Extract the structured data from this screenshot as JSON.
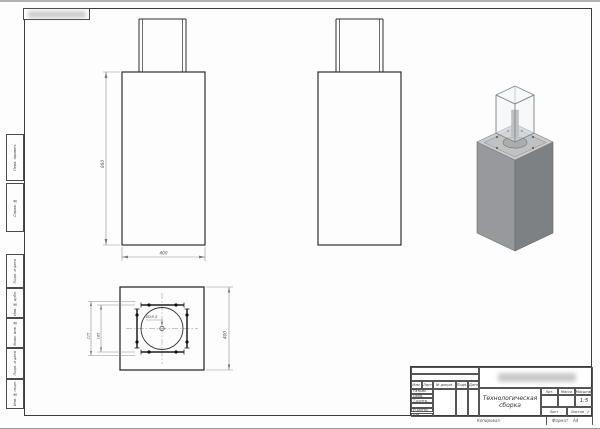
{
  "margin_labels": [
    {
      "label": "Перв. примен."
    },
    {
      "label": "Справ. №"
    },
    {
      "label": "Подп. и дата"
    },
    {
      "label": "Инв. № дубл."
    },
    {
      "label": "Взам. инв. №"
    },
    {
      "label": "Подп. и дата"
    },
    {
      "label": "Инв. № подл."
    }
  ],
  "views": {
    "front": {
      "height_dim": "860",
      "width_dim": "400"
    },
    "plan": {
      "outer_dim": "400",
      "rail_outer_dim": "215",
      "rail_inner_dim": "185",
      "hole_dim": "Ø28,5"
    }
  },
  "title_block": {
    "title": "Технологическая\nсборка",
    "col_izm": "Изм.",
    "col_list": "Лист",
    "col_doc": "№ докум.",
    "col_sign": "Подп.",
    "col_date": "Дата",
    "rows": [
      "Разраб.",
      "Пров.",
      "Т.контр.",
      "",
      "Н.контр.",
      "Утв."
    ],
    "lit": "Лит.",
    "mass": "Масса",
    "scale_label": "Масштаб",
    "scale_value": "1:5",
    "sheet_label": "Лист",
    "sheets_label": "Листов",
    "sheets_value": "1"
  },
  "footer": {
    "copied": "Копировал",
    "format_label": "Формат",
    "format_value": "A4"
  },
  "colors": {
    "object_line": "#2f2f2f",
    "dim_line": "#8f8f8f",
    "face_left": "#97999c",
    "face_right": "#7e8184",
    "face_top": "#c9cbcd"
  }
}
